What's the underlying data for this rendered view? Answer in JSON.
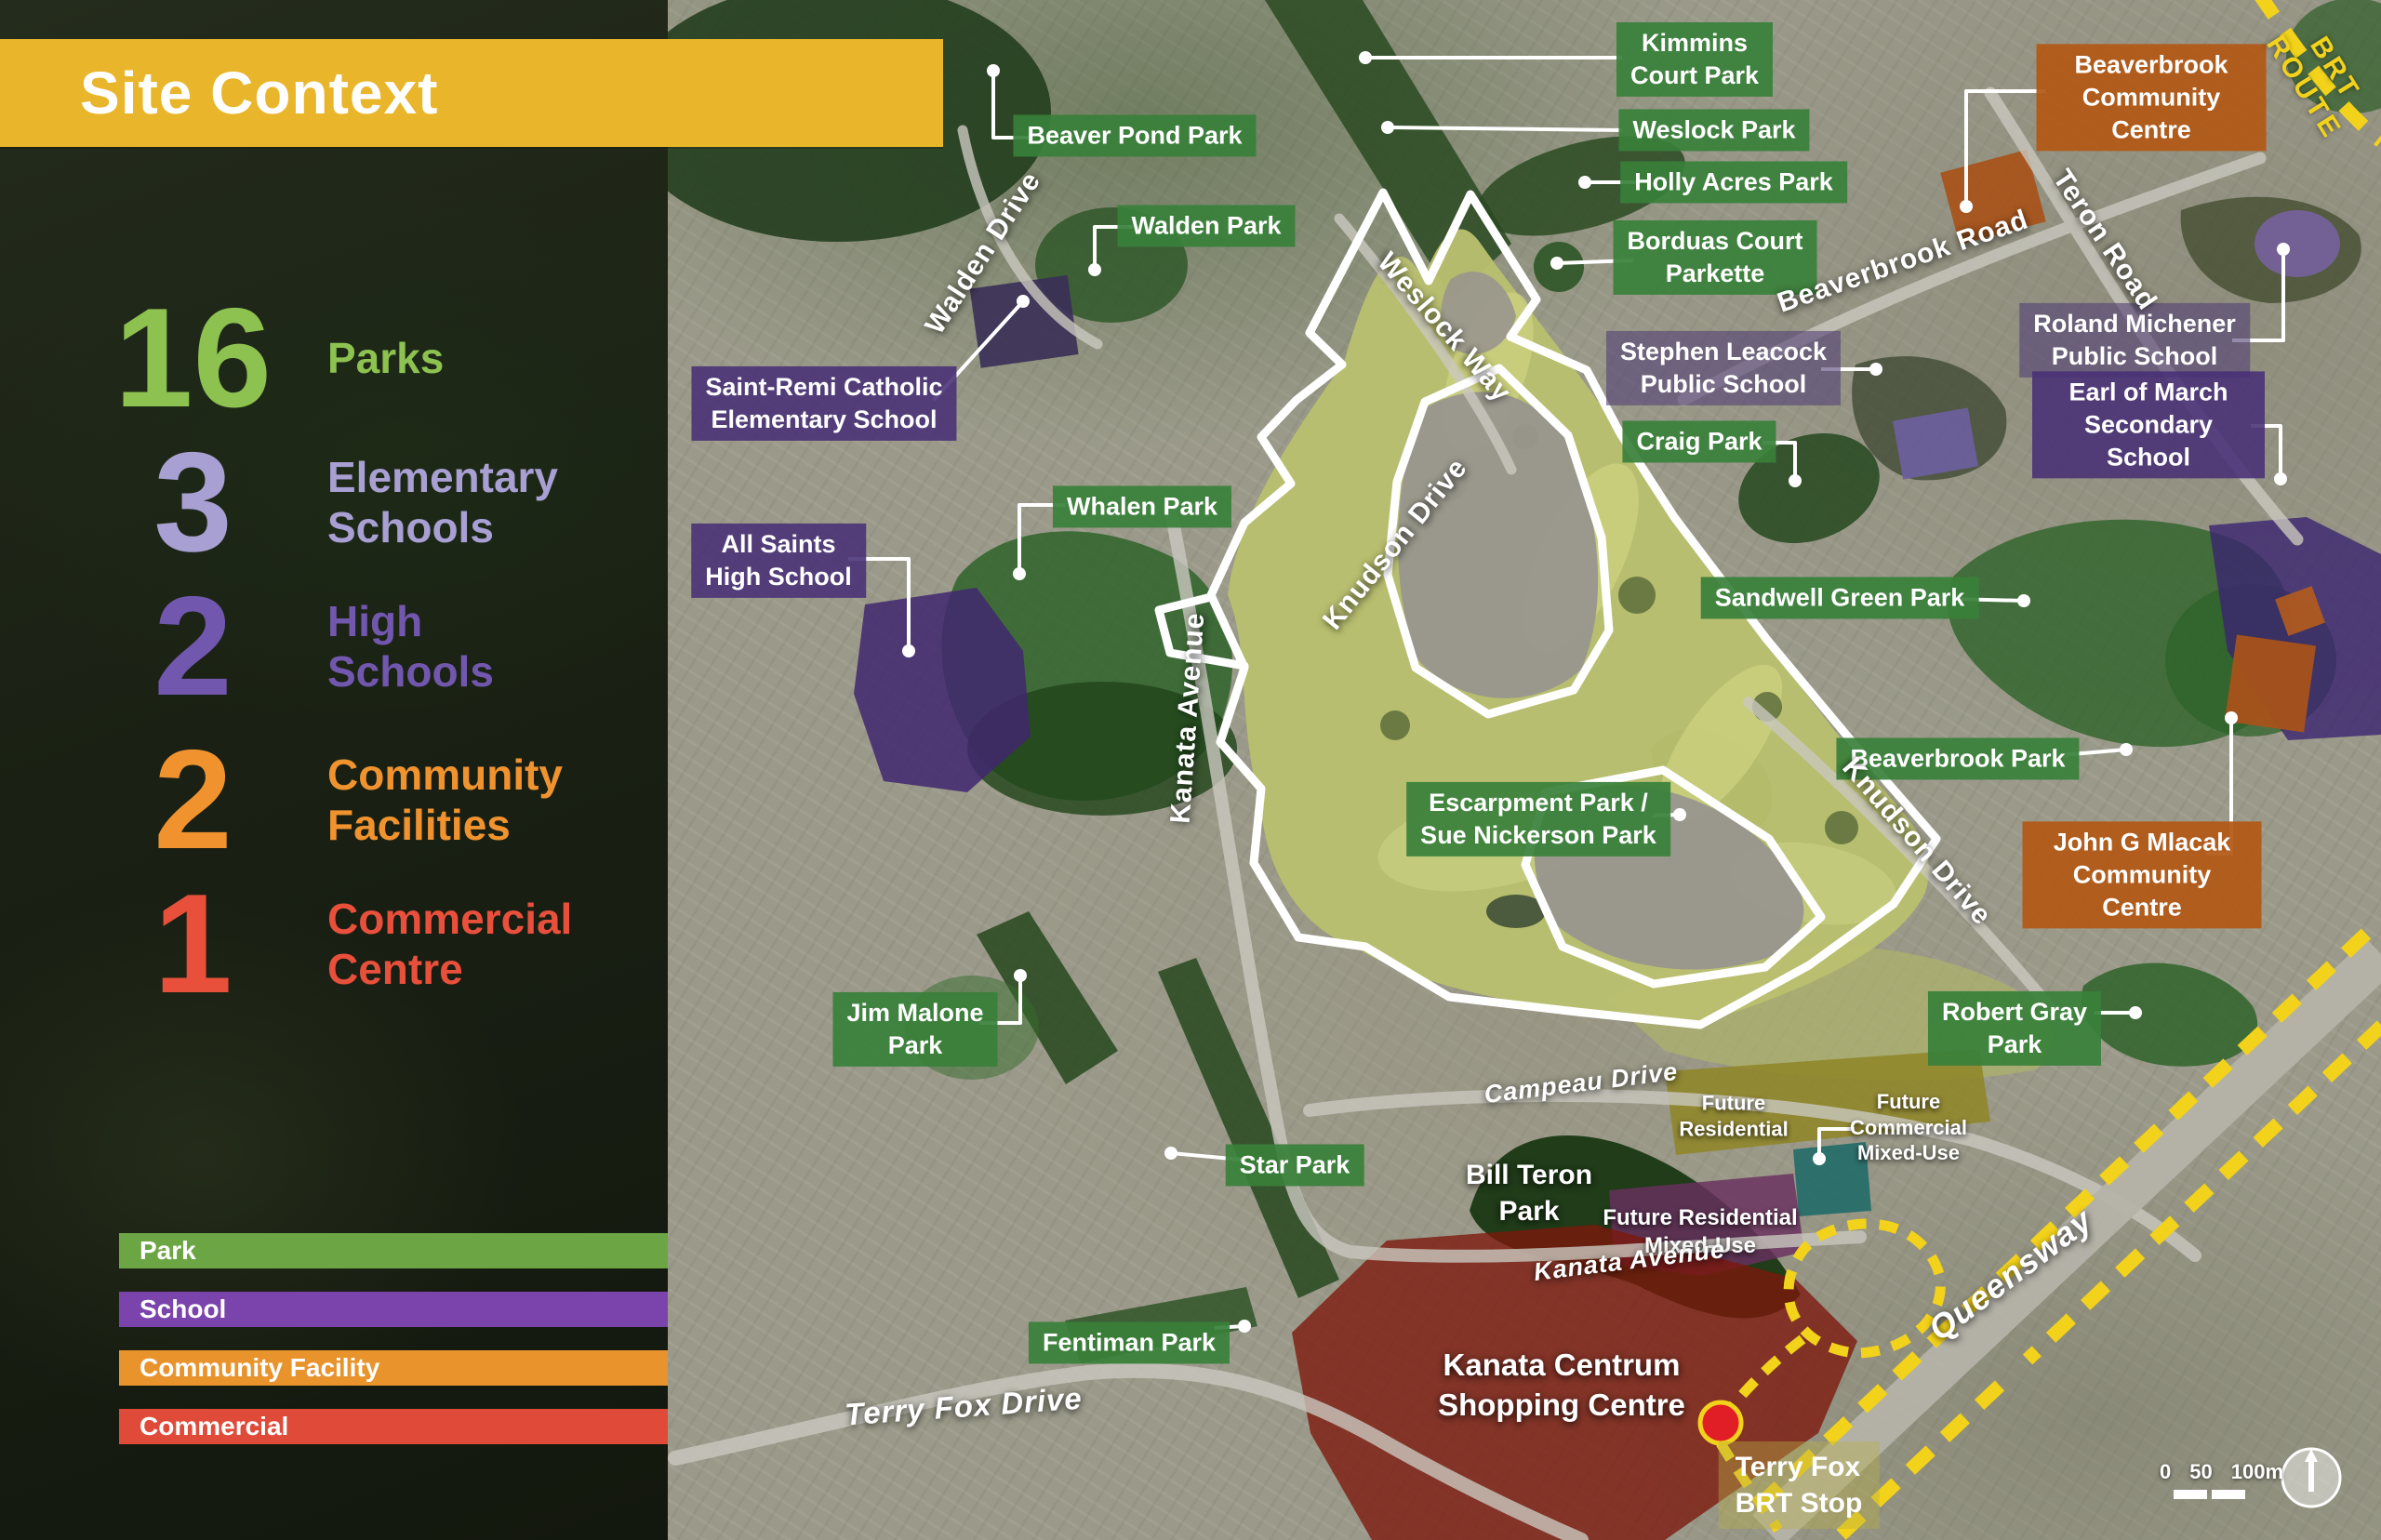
{
  "banner": {
    "title": "Site Context",
    "bg_color": "#e9b52b"
  },
  "stats": [
    {
      "value": "16",
      "label": "Parks",
      "color": "#8dc150"
    },
    {
      "value": "3",
      "label": "Elementary\nSchools",
      "color": "#a89fd3"
    },
    {
      "value": "2",
      "label": "High\nSchools",
      "color": "#7257ae"
    },
    {
      "value": "2",
      "label": "Community\nFacilities",
      "color": "#f0932f"
    },
    {
      "value": "1",
      "label": "Commercial\nCentre",
      "color": "#e8503c"
    }
  ],
  "legend": {
    "heading": "Legend",
    "items": [
      {
        "label": "Park",
        "color": "#6ca644"
      },
      {
        "label": "School",
        "color": "#7b44ad"
      },
      {
        "label": "Community Facility",
        "color": "#e8932c"
      },
      {
        "label": "Commercial",
        "color": "#e04a39"
      }
    ]
  },
  "map": {
    "labels": {
      "kimmins": {
        "text": "Kimmins\nCourt Park"
      },
      "weslock_park": {
        "text": "Weslock Park"
      },
      "holly_acres": {
        "text": "Holly Acres Park"
      },
      "borduas": {
        "text": "Borduas Court\nParkette"
      },
      "beaver_pond": {
        "text": "Beaver Pond Park"
      },
      "walden_park": {
        "text": "Walden Park"
      },
      "beaverbrook_cc": {
        "text": "Beaverbrook\nCommunity Centre"
      },
      "roland_michener": {
        "text": "Roland Michener\nPublic School"
      },
      "earl_of_march": {
        "text": "Earl of March\nSecondary School"
      },
      "saint_remi": {
        "text": "Saint-Remi Catholic\nElementary School"
      },
      "all_saints": {
        "text": "All Saints\nHigh School"
      },
      "whalen": {
        "text": "Whalen Park"
      },
      "stephen_leacock": {
        "text": "Stephen Leacock\nPublic School"
      },
      "craig": {
        "text": "Craig Park"
      },
      "sandwell": {
        "text": "Sandwell Green Park"
      },
      "beaverbrook_park": {
        "text": "Beaverbrook Park"
      },
      "mlacak": {
        "text": "John G Mlacak\nCommunity Centre"
      },
      "escarpment": {
        "text": "Escarpment Park /\nSue Nickerson Park"
      },
      "jim_malone": {
        "text": "Jim Malone\nPark"
      },
      "robert_gray": {
        "text": "Robert Gray\nPark"
      },
      "star": {
        "text": "Star Park"
      },
      "bill_teron": {
        "text": "Bill Teron\nPark"
      },
      "future_residential": {
        "text": "Future\nResidential"
      },
      "future_commercial": {
        "text": "Future\nCommercial\nMixed-Use"
      },
      "future_res_mixed": {
        "text": "Future Residential\nMixed-Use"
      },
      "fentiman": {
        "text": "Fentiman Park"
      },
      "kanata_centrum": {
        "text": "Kanata Centrum\nShopping Centre"
      },
      "terry_fox_brt": {
        "text": "Terry Fox\nBRT Stop"
      }
    },
    "roads": {
      "terry_fox_drive": {
        "text": "Terry Fox Drive"
      },
      "kanata_avenue": {
        "text": "Kanata Avenue"
      },
      "walden_drive": {
        "text": "Walden Drive"
      },
      "weslock_way": {
        "text": "Weslock Way"
      },
      "knudson_drive": {
        "text": "Knudson Drive"
      },
      "beaverbrook_road": {
        "text": "Beaverbrook Road"
      },
      "teron_road": {
        "text": "Teron Road"
      },
      "campeau_drive": {
        "text": "Campeau Drive"
      },
      "queensway": {
        "text": "Queensway"
      },
      "brt_route": {
        "text": "BRT ROUTE"
      }
    },
    "colors": {
      "park_label": "#38803a",
      "school_label": "#483076",
      "facility_label": "#b25816",
      "commercial_area": "#7c170c",
      "brt_route_yellow": "#f2d21a",
      "golf_course": "#b9bf6e",
      "site_outline": "#ffffff"
    },
    "scale_bar": {
      "ticks": [
        "0",
        "50",
        "100m"
      ]
    }
  }
}
